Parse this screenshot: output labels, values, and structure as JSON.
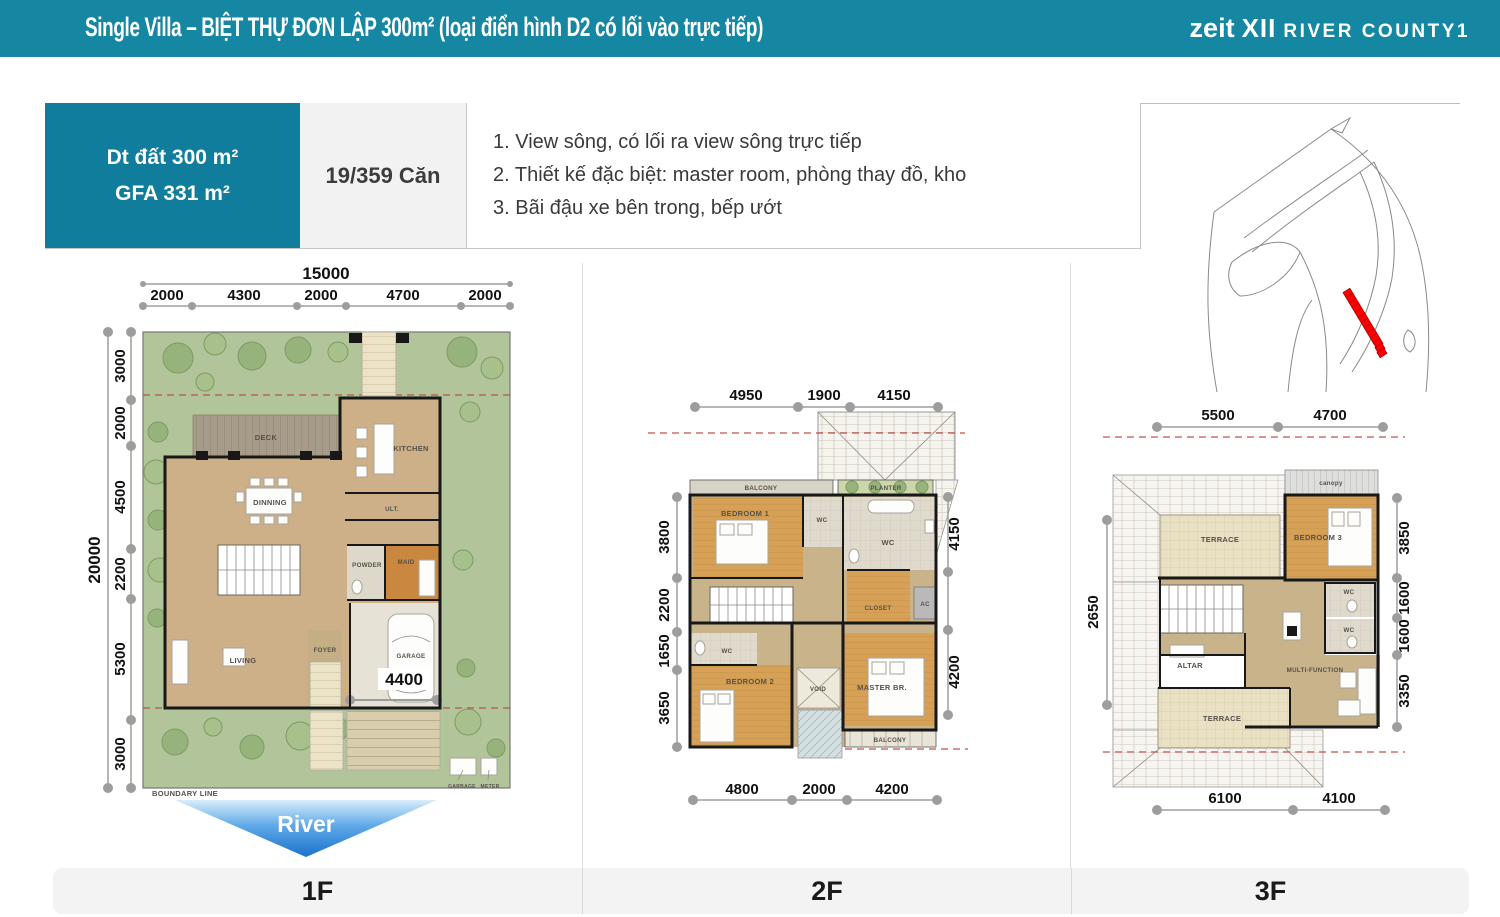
{
  "header": {
    "title": "Single Villa – BIỆT THỰ ĐƠN LẬP 300m² (loại điển hình D2 có lối vào trực tiếp)",
    "brand": "zeit",
    "brand_mark": "XII",
    "brand_name": "RIVER COUNTY1"
  },
  "summary": {
    "land_area": "Dt đất 300 m²",
    "gfa": "GFA 331 m²",
    "units": "19/359 Căn"
  },
  "features": [
    "1. View sông, có lối ra view sông trực tiếp",
    "2. Thiết kế đặc biệt: master room, phòng thay đồ, kho",
    "3. Bãi đậu xe bên trong, bếp ướt"
  ],
  "river_label": "River",
  "floor_tabs": [
    "1F",
    "2F",
    "3F"
  ],
  "plans": {
    "f1": {
      "total_width": "15000",
      "top_dims": [
        "2000",
        "4300",
        "2000",
        "4700",
        "2000"
      ],
      "total_height": "20000",
      "left_dims": [
        "3000",
        "2000",
        "4500",
        "2200",
        "5300",
        "3000"
      ],
      "garage_dim": "4400",
      "rooms": {
        "deck": "DECK",
        "kitchen": "KITCHEN",
        "dinning": "DINNING",
        "ult": "ULT.",
        "powder": "POWDER",
        "maid": "MAID",
        "foyer": "FOYER",
        "living": "LIVING",
        "garage": "GARAGE"
      },
      "boundary_label": "BOUNDARY LINE",
      "garbage_label": "GARBAGE",
      "meter_label": "METER"
    },
    "f2": {
      "top_dims": [
        "4950",
        "1900",
        "4150"
      ],
      "left_dims": [
        "3800",
        "2200",
        "1650",
        "3650"
      ],
      "right_dims": [
        "4150",
        "4200"
      ],
      "bottom_dims": [
        "4800",
        "2000",
        "4200"
      ],
      "rooms": {
        "balcony_top": "BALCONY",
        "planter": "PLANTER",
        "bedroom1": "BEDROOM 1",
        "wc1": "WC",
        "wc2": "WC",
        "closet": "CLOSET",
        "ac": "AC",
        "wc3": "WC",
        "bedroom2": "BEDROOM 2",
        "void": "VOID",
        "master": "MASTER BR.",
        "balcony_bottom": "BALCONY"
      }
    },
    "f3": {
      "top_dims": [
        "5500",
        "4700"
      ],
      "left_dims": [
        "2650"
      ],
      "right_dims": [
        "3850",
        "1600",
        "1600",
        "3350"
      ],
      "bottom_dims": [
        "6100",
        "4100"
      ],
      "rooms": {
        "canopy": "canopy",
        "terrace_top": "TERRACE",
        "bedroom3": "BEDROOM 3",
        "wc1": "WC",
        "wc2": "WC",
        "altar": "ALTAR",
        "multi": "MULTI-FUNCTION",
        "terrace_bottom": "TERRACE"
      }
    }
  },
  "colors": {
    "header_teal": "#1687A3",
    "box_teal": "#0F7D9B",
    "unit_red": "#FF0000",
    "river_blue": "#1A72CC"
  }
}
